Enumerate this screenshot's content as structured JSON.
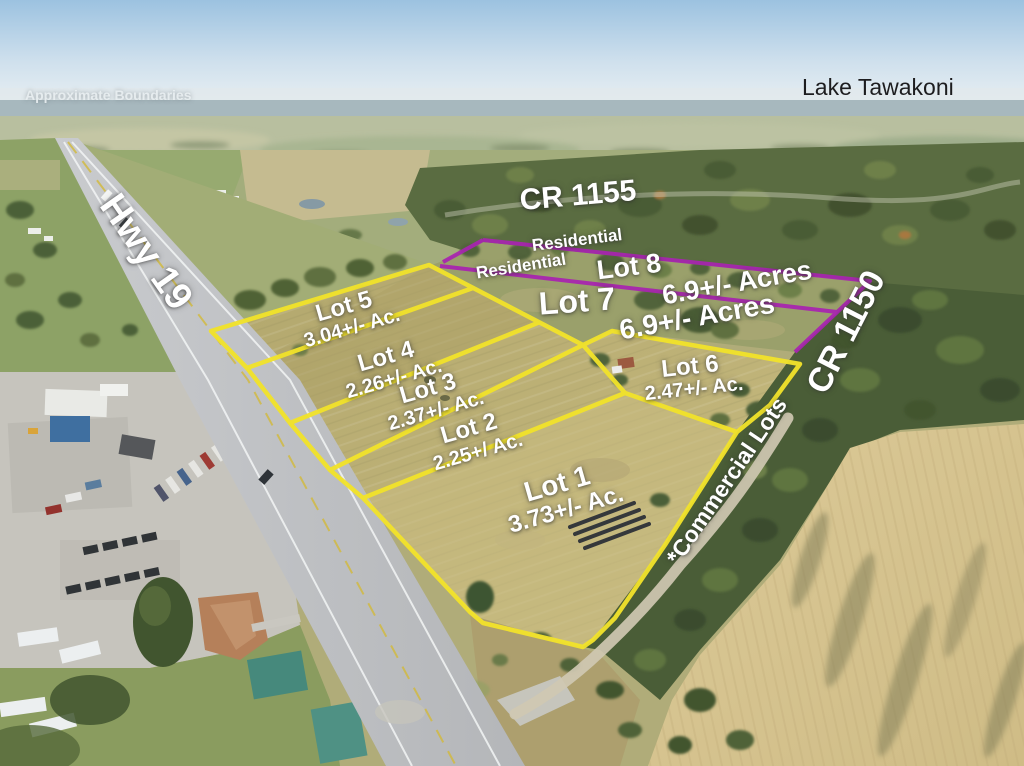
{
  "watermark": "Approximate Boundaries",
  "landmarks": {
    "lake": "Lake Tawakoni"
  },
  "roads": {
    "hwy_19": "Hwy 19",
    "cr_1155": "CR 1155",
    "cr_1150": "CR 1150"
  },
  "zones": {
    "residential_outer_label": "Residential",
    "residential_inner_label": "Residential",
    "commercial_note": "*Commercial Lots"
  },
  "lots": [
    {
      "name": "Lot 1",
      "size": "3.73+/- Ac."
    },
    {
      "name": "Lot 2",
      "size": "2.25+/ Ac."
    },
    {
      "name": "Lot 3",
      "size": "2.37+/- Ac."
    },
    {
      "name": "Lot 4",
      "size": "2.26+/- Ac."
    },
    {
      "name": "Lot 5",
      "size": "3.04+/- Ac."
    },
    {
      "name": "Lot 6",
      "size": "2.47+/- Ac."
    },
    {
      "name": "Lot 7",
      "size": "6.9+/- Acres"
    },
    {
      "name": "Lot 8",
      "size": "6.9+/- Acres"
    }
  ],
  "colors": {
    "commercial_outline": "#f2e32a",
    "residential_outline": "#a824b0",
    "lot_label_text": "#ffffff",
    "landmark_label_text": "#1d1d1f",
    "watermark_text": "#e8edee"
  }
}
